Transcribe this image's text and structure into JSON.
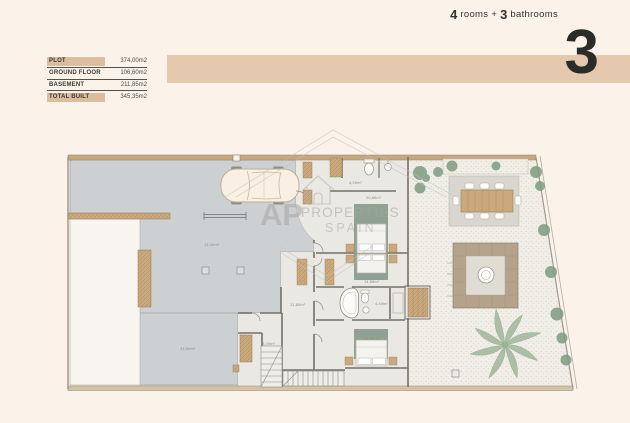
{
  "header": {
    "table": {
      "rows": [
        {
          "label": "PLOT",
          "value": "374,00m2",
          "highlight": true
        },
        {
          "label": "GROUND FLOOR",
          "value": "106,60m2",
          "highlight": false
        },
        {
          "label": "BASEMENT",
          "value": "211,85m2",
          "highlight": false
        },
        {
          "label": "TOTAL BUILT",
          "value": "345,35m2",
          "highlight": true
        }
      ]
    },
    "banner": {
      "num_rooms": "4",
      "rooms_word": "rooms",
      "plus": "+",
      "num_baths": "3",
      "baths_word": "bathrooms",
      "floor_number": "3"
    }
  },
  "watermark": {
    "prefix": "AP",
    "rest": "PROPERTIES",
    "sub": "SPAIN"
  },
  "plan": {
    "room_labels": [
      {
        "text": "4,50m²"
      },
      {
        "text": "20,60m²"
      },
      {
        "text": "14,80m²"
      },
      {
        "text": "4,40m²"
      },
      {
        "text": "11,80m²"
      },
      {
        "text": "14,80m²"
      },
      {
        "text": "6,00m²"
      },
      {
        "text": "13,40m²"
      },
      {
        "text": "33,60m²"
      }
    ]
  },
  "colors": {
    "bg": "#fbf2ea",
    "tan": "#e4c9ae",
    "tanDark": "#dcbd9e",
    "driveway": "#ccd0d3",
    "floor": "#eae8e3",
    "rug": "#8fa291",
    "wood": "#cba97c",
    "garden": "#f0eee7",
    "bush": "#7d9c80",
    "palm": "#a3bba0",
    "wall": "#71706b",
    "patio": "#d8d6ce",
    "firepit": "#b5a28c",
    "firepitIn": "#dfdcd4"
  }
}
